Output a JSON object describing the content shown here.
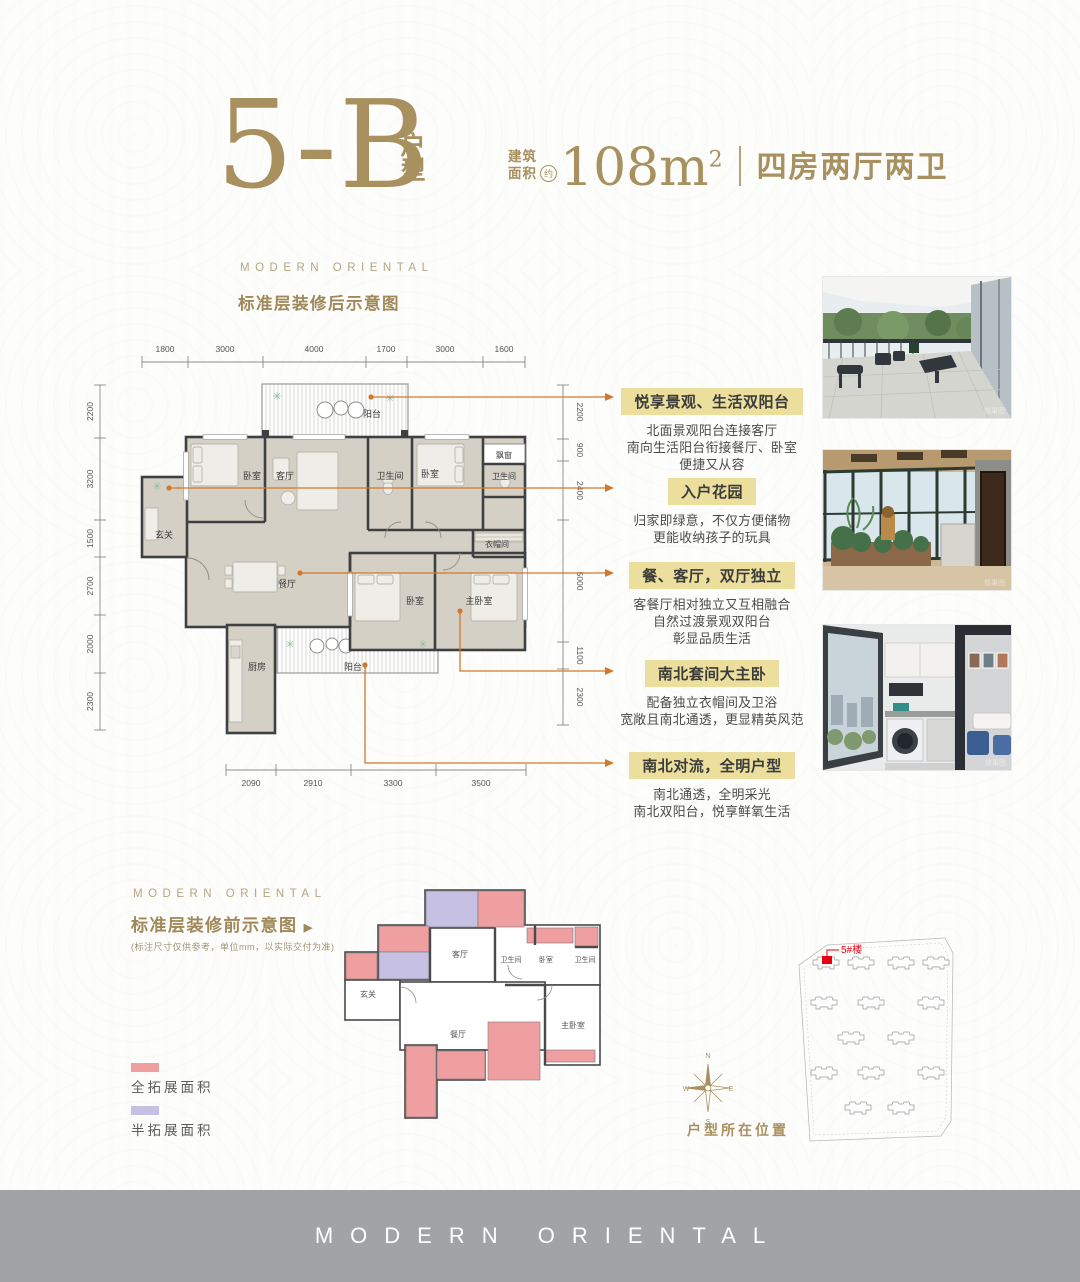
{
  "colors": {
    "gold": "#a8905f",
    "leader_orange": "#d4772b",
    "callout_header_bg": "#ecdf9d",
    "full_expand_pink": "#f09fa0",
    "half_expand_purple": "#c6c0e2",
    "footer_gray": "#a1a4a7",
    "wall_dark": "#3f4041",
    "floor_beige": "#d5d0c6",
    "highlight_red": "#e60012"
  },
  "header": {
    "unit_code": "5-B",
    "unit_label": "户型",
    "area_prefix_line1": "建筑",
    "area_prefix_line2": "面积",
    "area_approx": "约",
    "area_value": "108m",
    "area_sup": "2",
    "layout_desc": "四房两厅两卫"
  },
  "after_section": {
    "brand": "MODERN ORIENTAL",
    "title": "标准层装修后示意图"
  },
  "floor_plan": {
    "dims_top": [
      "1800",
      "3000",
      "4000",
      "1700",
      "3000",
      "1600"
    ],
    "dims_left": [
      "2200",
      "3200",
      "1500",
      "2700",
      "2000",
      "2300"
    ],
    "dims_right": [
      "2200",
      "900",
      "2400",
      "5000",
      "1100",
      "2300"
    ],
    "dims_bottom": [
      "2090",
      "2910",
      "3300",
      "3500"
    ],
    "rooms": {
      "balcony_top": "阳台",
      "bedroom_nw": "卧室",
      "living": "客厅",
      "bath_a": "卫生间",
      "bedroom_ne": "卧室",
      "bay_window": "飘窗",
      "bath_b": "卫生间",
      "foyer": "玄关",
      "cloakroom": "衣帽间",
      "dining": "餐厅",
      "bedroom_s": "卧室",
      "master": "主卧室",
      "kitchen": "厨房",
      "balcony_s": "阳台"
    }
  },
  "callouts": [
    {
      "title": "悦享景观、生活双阳台",
      "lines": [
        "北面景观阳台连接客厅",
        "南向生活阳台衔接餐厅、卧室",
        "便捷又从容"
      ]
    },
    {
      "title": "入户花园",
      "lines": [
        "归家即绿意，不仅方便储物",
        "更能收纳孩子的玩具"
      ]
    },
    {
      "title": "餐、客厅，双厅独立",
      "lines": [
        "客餐厅相对独立又互相融合",
        "自然过渡景观双阳台",
        "彰显品质生活"
      ]
    },
    {
      "title": "南北套间大主卧",
      "lines": [
        "配备独立衣帽间及卫浴",
        "宽敞且南北通透，更显精英风范"
      ]
    },
    {
      "title": "南北对流，全明户型",
      "lines": [
        "南北通透，全明采光",
        "南北双阳台，悦享鲜氧生活"
      ]
    }
  ],
  "photos": {
    "watermark": "效果图"
  },
  "before_section": {
    "brand": "MODERN ORIENTAL",
    "title": "标准层装修前示意图",
    "arrow": "▶",
    "note": "(标注尺寸仅供参考，单位mm，以实际交付为准)",
    "legend_full": "全拓展面积",
    "legend_half": "半拓展面积",
    "rooms": {
      "living": "客厅",
      "bath_a": "卫生间",
      "bedroom": "卧室",
      "bath_b": "卫生间",
      "foyer": "玄关",
      "dining": "餐厅",
      "master": "主卧室"
    }
  },
  "site": {
    "building_label": "5#楼",
    "caption": "户型所在位置",
    "compass": {
      "n": "N",
      "e": "E",
      "s": "S",
      "w": "W"
    }
  },
  "footer": {
    "brand": "MODERN ORIENTAL"
  }
}
